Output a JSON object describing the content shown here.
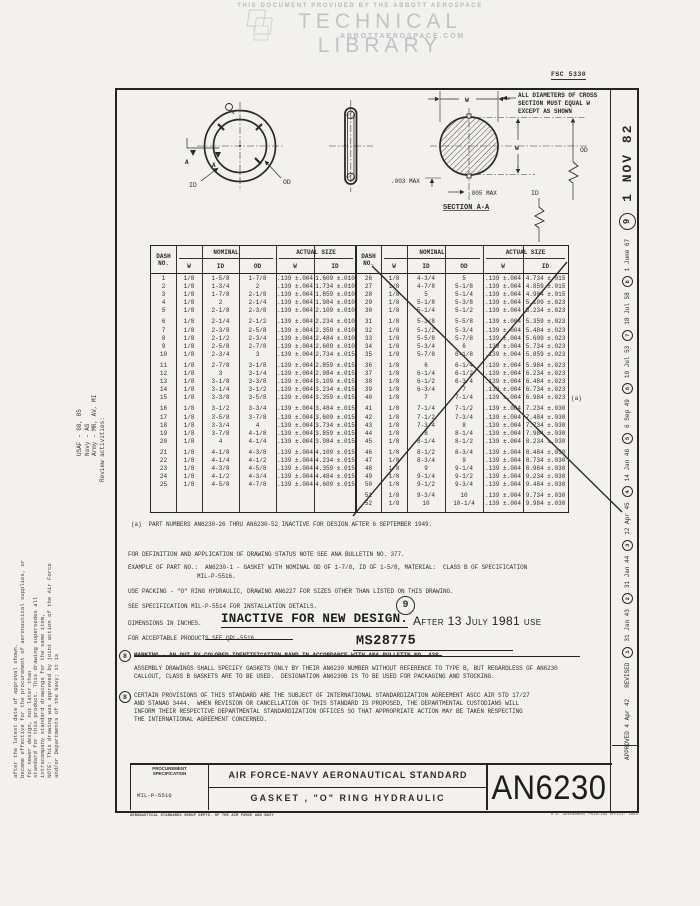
{
  "watermark": {
    "line1": "THIS DOCUMENT PROVIDED BY THE ABBOTT AEROSPACE",
    "line2": "TECHNICAL LIBRARY",
    "line3": "ABBOTTAEROSPACE.COM"
  },
  "fsc_number": "FSC 5330",
  "diagram": {
    "front_view": {
      "id_label": "ID",
      "od_label": "OD",
      "section_letter": "A"
    },
    "section_view": {
      "title": "SECTION A-A",
      "note_line1": "ALL DIAMETERS OF CROSS",
      "note_line2": "SECTION MUST EQUAL W",
      "note_line3": "EXCEPT AS SHOWN",
      "w_label": "W",
      "od_label": "OD",
      "id_label": "ID",
      "flash_max": ".003 MAX",
      "offset_max": ".005 MAX"
    }
  },
  "tables": {
    "headers": {
      "dash": "DASH",
      "no": "NO.",
      "nominal": "NOMINAL",
      "actual": "ACTUAL SIZE",
      "w": "W",
      "id": "ID",
      "od": "OD"
    },
    "footnote_ref": "(a)",
    "left_rows": [
      [
        "1",
        "1/8",
        "1-5/8",
        "1-7/8",
        ".139 ±.004",
        "1.609 ±.010"
      ],
      [
        "2",
        "1/8",
        "1-3/4",
        "2",
        ".139 ±.004",
        "1.734 ±.010"
      ],
      [
        "3",
        "1/8",
        "1-7/8",
        "2-1/8",
        ".139 ±.004",
        "1.859 ±.010"
      ],
      [
        "4",
        "1/8",
        "2",
        "2-1/4",
        ".139 ±.004",
        "1.984 ±.010"
      ],
      [
        "5",
        "1/8",
        "2-1/8",
        "2-3/8",
        ".139 ±.004",
        "2.109 ±.010"
      ],
      [
        "6",
        "1/8",
        "2-1/4",
        "2-1/2",
        ".139 ±.004",
        "2.234 ±.010"
      ],
      [
        "7",
        "1/8",
        "2-3/8",
        "2-5/8",
        ".139 ±.004",
        "2.359 ±.010"
      ],
      [
        "8",
        "1/8",
        "2-1/2",
        "2-3/4",
        ".139 ±.004",
        "2.484 ±.010"
      ],
      [
        "9",
        "1/8",
        "2-5/8",
        "2-7/8",
        ".139 ±.004",
        "2.609 ±.010"
      ],
      [
        "10",
        "1/8",
        "2-3/4",
        "3",
        ".139 ±.004",
        "2.734 ±.015"
      ],
      [
        "11",
        "1/8",
        "2-7/8",
        "3-1/8",
        ".139 ±.004",
        "2.859 ±.015"
      ],
      [
        "12",
        "1/8",
        "3",
        "3-1/4",
        ".139 ±.004",
        "2.984 ±.015"
      ],
      [
        "13",
        "1/8",
        "3-1/8",
        "3-3/8",
        ".139 ±.004",
        "3.109 ±.015"
      ],
      [
        "14",
        "1/8",
        "3-1/4",
        "3-1/2",
        ".139 ±.004",
        "3.234 ±.015"
      ],
      [
        "15",
        "1/8",
        "3-3/8",
        "3-5/8",
        ".139 ±.004",
        "3.359 ±.015"
      ],
      [
        "16",
        "1/8",
        "3-1/2",
        "3-3/4",
        ".139 ±.004",
        "3.484 ±.015"
      ],
      [
        "17",
        "1/8",
        "3-5/8",
        "3-7/8",
        ".139 ±.004",
        "3.609 ±.015"
      ],
      [
        "18",
        "1/8",
        "3-3/4",
        "4",
        ".139 ±.004",
        "3.734 ±.015"
      ],
      [
        "19",
        "1/8",
        "3-7/8",
        "4-1/8",
        ".139 ±.004",
        "3.859 ±.015"
      ],
      [
        "20",
        "1/8",
        "4",
        "4-1/4",
        ".139 ±.004",
        "3.984 ±.015"
      ],
      [
        "21",
        "1/8",
        "4-1/8",
        "4-3/8",
        ".139 ±.004",
        "4.109 ±.015"
      ],
      [
        "22",
        "1/8",
        "4-1/4",
        "4-1/2",
        ".139 ±.004",
        "4.234 ±.015"
      ],
      [
        "23",
        "1/8",
        "4-3/8",
        "4-5/8",
        ".139 ±.004",
        "4.359 ±.015"
      ],
      [
        "24",
        "1/8",
        "4-1/2",
        "4-3/4",
        ".139 ±.004",
        "4.484 ±.015"
      ],
      [
        "25",
        "1/8",
        "4-5/8",
        "4-7/8",
        ".139 ±.004",
        "4.609 ±.015"
      ]
    ],
    "right_rows": [
      [
        "26",
        "1/8",
        "4-3/4",
        "5",
        ".139 ±.004",
        "4.734 ±.015"
      ],
      [
        "27",
        "1/8",
        "4-7/8",
        "5-1/8",
        ".139 ±.004",
        "4.859 ±.015"
      ],
      [
        "28",
        "1/8",
        "5",
        "5-1/4",
        ".139 ±.004",
        "4.984 ±.015"
      ],
      [
        "29",
        "1/8",
        "5-1/8",
        "5-3/8",
        ".139 ±.004",
        "5.109 ±.023"
      ],
      [
        "30",
        "1/8",
        "5-1/4",
        "5-1/2",
        ".139 ±.004",
        "5.234 ±.023"
      ],
      [
        "31",
        "1/8",
        "5-3/8",
        "5-5/8",
        ".139 ±.004",
        "5.359 ±.023"
      ],
      [
        "32",
        "1/8",
        "5-1/2",
        "5-3/4",
        ".139 ±.004",
        "5.484 ±.023"
      ],
      [
        "33",
        "1/8",
        "5-5/8",
        "5-7/8",
        ".139 ±.004",
        "5.609 ±.023"
      ],
      [
        "34",
        "1/8",
        "5-3/4",
        "6",
        ".139 ±.004",
        "5.734 ±.023"
      ],
      [
        "35",
        "1/8",
        "5-7/8",
        "6-1/8",
        ".139 ±.004",
        "5.859 ±.023"
      ],
      [
        "36",
        "1/8",
        "6",
        "6-1/4",
        ".139 ±.004",
        "5.984 ±.023"
      ],
      [
        "37",
        "1/8",
        "6-1/4",
        "6-1/2",
        ".139 ±.004",
        "6.234 ±.023"
      ],
      [
        "38",
        "1/8",
        "6-1/2",
        "6-3/4",
        ".139 ±.004",
        "6.484 ±.023"
      ],
      [
        "39",
        "1/8",
        "6-3/4",
        "7",
        ".139 ±.004",
        "6.734 ±.023"
      ],
      [
        "40",
        "1/8",
        "7",
        "7-1/4",
        ".139 ±.004",
        "6.984 ±.023"
      ],
      [
        "41",
        "1/8",
        "7-1/4",
        "7-1/2",
        ".139 ±.004",
        "7.234 ±.030"
      ],
      [
        "42",
        "1/8",
        "7-1/2",
        "7-3/4",
        ".139 ±.004",
        "7.484 ±.030"
      ],
      [
        "43",
        "1/8",
        "7-3/4",
        "8",
        ".139 ±.004",
        "7.734 ±.030"
      ],
      [
        "44",
        "1/8",
        "8",
        "8-1/4",
        ".139 ±.004",
        "7.984 ±.030"
      ],
      [
        "45",
        "1/8",
        "8-1/4",
        "8-1/2",
        ".139 ±.004",
        "8.234 ±.030"
      ],
      [
        "46",
        "1/8",
        "8-1/2",
        "8-3/4",
        ".139 ±.004",
        "8.484 ±.030"
      ],
      [
        "47",
        "1/8",
        "8-3/4",
        "9",
        ".139 ±.004",
        "8.734 ±.030"
      ],
      [
        "48",
        "1/8",
        "9",
        "9-1/4",
        ".139 ±.004",
        "8.984 ±.030"
      ],
      [
        "49",
        "1/8",
        "9-1/4",
        "9-1/2",
        ".139 ±.004",
        "9.234 ±.030"
      ],
      [
        "50",
        "1/8",
        "9-1/2",
        "9-3/4",
        ".139 ±.004",
        "9.484 ±.030"
      ],
      [
        "51",
        "1/8",
        "9-3/4",
        "10",
        ".139 ±.004",
        "9.734 ±.030"
      ],
      [
        "52",
        "1/8",
        "10",
        "10-1/4",
        ".139 ±.004",
        "9.984 ±.030"
      ]
    ]
  },
  "notes": {
    "footnote_a": "(a)  PART NUMBERS AN6230-26 THRU AN6230-52 INACTIVE FOR DESIGN AFTER 6 SEPTEMBER 1949.",
    "definition": "FOR DEFINITION AND APPLICATION OF DRAWING STATUS NOTE SEE ANA BULLETIN NO. 377.",
    "example_line1": "EXAMPLE OF PART NO.:  AN6230-1 - GASKET WITH NOMINAL OD OF 1-7/8, ID OF 1-5/8, MATERIAL:  CLASS B OF SPECIFICATION",
    "example_line2": "MIL-P-5516.",
    "use_packing": "USE PACKING - \"O\" RING HYDRAULIC, DRAWING AN6227 FOR SIZES OTHER THAN LISTED ON THIS DRAWING.",
    "spec": "SEE SPECIFICATION MIL-P-5514 FOR INSTALLATION DETAILS.",
    "dimensions": "DIMENSIONS IN INCHES.",
    "inactive_stamp": "INACTIVE FOR NEW DESIGN.",
    "after_text": "After 13 July 1981 use",
    "ms_number": "MS28775",
    "acceptable": "FOR ACCEPTABLE PRODUCTS SEE QPL-5516.",
    "ref_9": "9",
    "ref_8": "8",
    "marking_struck": "MARKING - AN OUT BY COLORED IDENTIFICATION BAND IN ACCORDANCE WITH ANA BULLETIN NO. 438.",
    "assembly_line1": "ASSEMBLY DRAWINGS SHALL SPECIFY GASKETS ONLY BY THEIR AN6230 NUMBER WITHOUT REFERENCE TO TYPE B, BUT REGARDLESS OF AN6230",
    "assembly_line2": "CALLOUT, CLASS B GASKETS ARE TO BE USED.  DESIGNATION AN6230B IS TO BE USED FOR PACKAGING AND STOCKING.",
    "provisions_line1": "CERTAIN PROVISIONS OF THIS STANDARD ARE THE SUBJECT OF INTERNATIONAL STANDARDIZATION AGREEMENT ASCC AIR STD 17/27",
    "provisions_line2": "AND STANAG 3444.  WHEN REVISION OR CANCELLATION OF THIS STANDARD IS PROPOSED, THE DEPARTMENTAL CUSTODIANS WILL",
    "provisions_line3": "INFORM THEIR RESPECTIVE DEPARTMENTAL STANDARDIZATION OFFICES SO THAT APPROPRIATE ACTION MAY BE TAKEN RESPECTING",
    "provisions_line4": "THE INTERNATIONAL AGREEMENT CONCERNED."
  },
  "title_block": {
    "proc_label_line1": "PROCUREMENT",
    "proc_label_line2": "SPECIFICATION",
    "proc_value": "MIL-P-5516",
    "standard_title": "AIR FORCE-NAVY AERONAUTICAL STANDARD",
    "part_title": "GASKET ,  \"O\"  RING   HYDRAULIC",
    "standard_number": "AN6230"
  },
  "footer": {
    "left": "AERONAUTICAL STANDARDS GROUP   DEPTS. OF THE AIR FORCE AND NAVY",
    "right": "U.S. GOVERNMENT PRINTING OFFICE: 1983"
  },
  "margins": {
    "review": {
      "header": "Review activities:",
      "item1": "Army – MR, AV, MI",
      "item2": "Navy – AS",
      "item3": "USAF – 68, 85"
    },
    "note_line1": "NOTE: This drawing was approved by joint action of the Air Force and/or Departments of the Navy; it is",
    "note_line2": "standard for this product.  This drawing supersedes all intracompany standard drawings for the same item,",
    "note_line3": "become effective for the procurement of aeronautical supplies, or for newer design, not later than",
    "note_line4": "after the latest date of approval shown.",
    "revisions": {
      "approved": "APPROVED 4 Apr 42",
      "revised_label": "REVISED",
      "entries": [
        {
          "num": "1",
          "date": "31 Jan 43"
        },
        {
          "num": "2",
          "date": "31 Jan 44"
        },
        {
          "num": "3",
          "date": "12 Apr 45"
        },
        {
          "num": "4",
          "date": "14 Jan 46"
        },
        {
          "num": "5",
          "date": "6 Sep 49"
        },
        {
          "num": "6",
          "date": "10 Jul 53"
        },
        {
          "num": "7",
          "date": "18 Jul 58"
        },
        {
          "num": "8",
          "date": "1 June 67"
        }
      ],
      "current_num": "9",
      "current_date": "1 NOV 82"
    }
  }
}
